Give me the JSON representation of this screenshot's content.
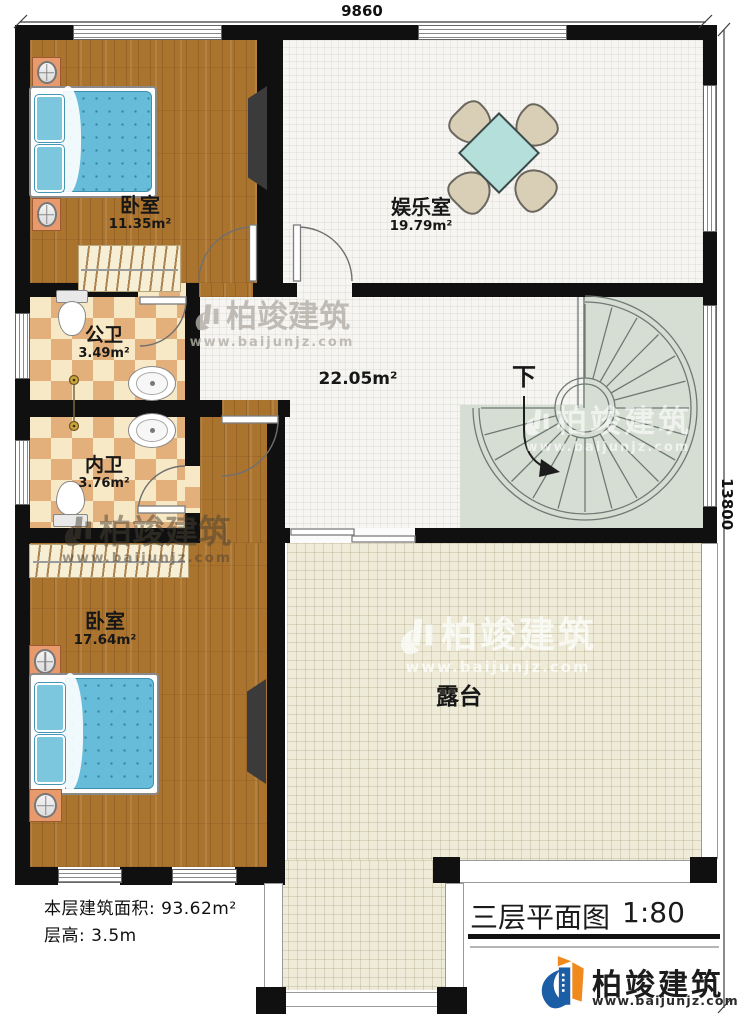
{
  "plan": {
    "dimension_top": "9860",
    "dimension_right": "13800"
  },
  "rooms": {
    "bedroom1": {
      "name": "卧室",
      "area": "11.35m²"
    },
    "entertainment": {
      "name": "娱乐室",
      "area": "19.79m²"
    },
    "hallway": {
      "area": "22.05m²"
    },
    "public_bath": {
      "name": "公卫",
      "area": "3.49m²"
    },
    "private_bath": {
      "name": "内卫",
      "area": "3.76m²"
    },
    "bedroom2": {
      "name": "卧室",
      "area": "17.64m²"
    },
    "terrace": {
      "name": "露台"
    },
    "staircase": {
      "direction_label": "下"
    }
  },
  "info": {
    "floor_area_label": "本层建筑面积:",
    "floor_area_value": "93.62m²",
    "floor_height_label": "层高:",
    "floor_height_value": "3.5m"
  },
  "title_block": {
    "title": "三层平面图",
    "scale": "1:80"
  },
  "brand": {
    "name": "柏竣建筑",
    "website": "www.baijunjz.com"
  },
  "watermark": {
    "name": "柏竣建筑",
    "website": "www.baijunjz.com"
  },
  "colors": {
    "wall": "#101010",
    "wood_floor": "#ab742e",
    "tile_light": "#f8e9c6",
    "tile_dark": "#e3b07b",
    "bed_blue": "#67bcd9",
    "table_teal": "#b4dfda",
    "terrace_floor": "#eeebd8",
    "stair_floor": "#d6ded3",
    "brand_blue": "#1b5ea6",
    "brand_orange": "#f08a1d"
  }
}
